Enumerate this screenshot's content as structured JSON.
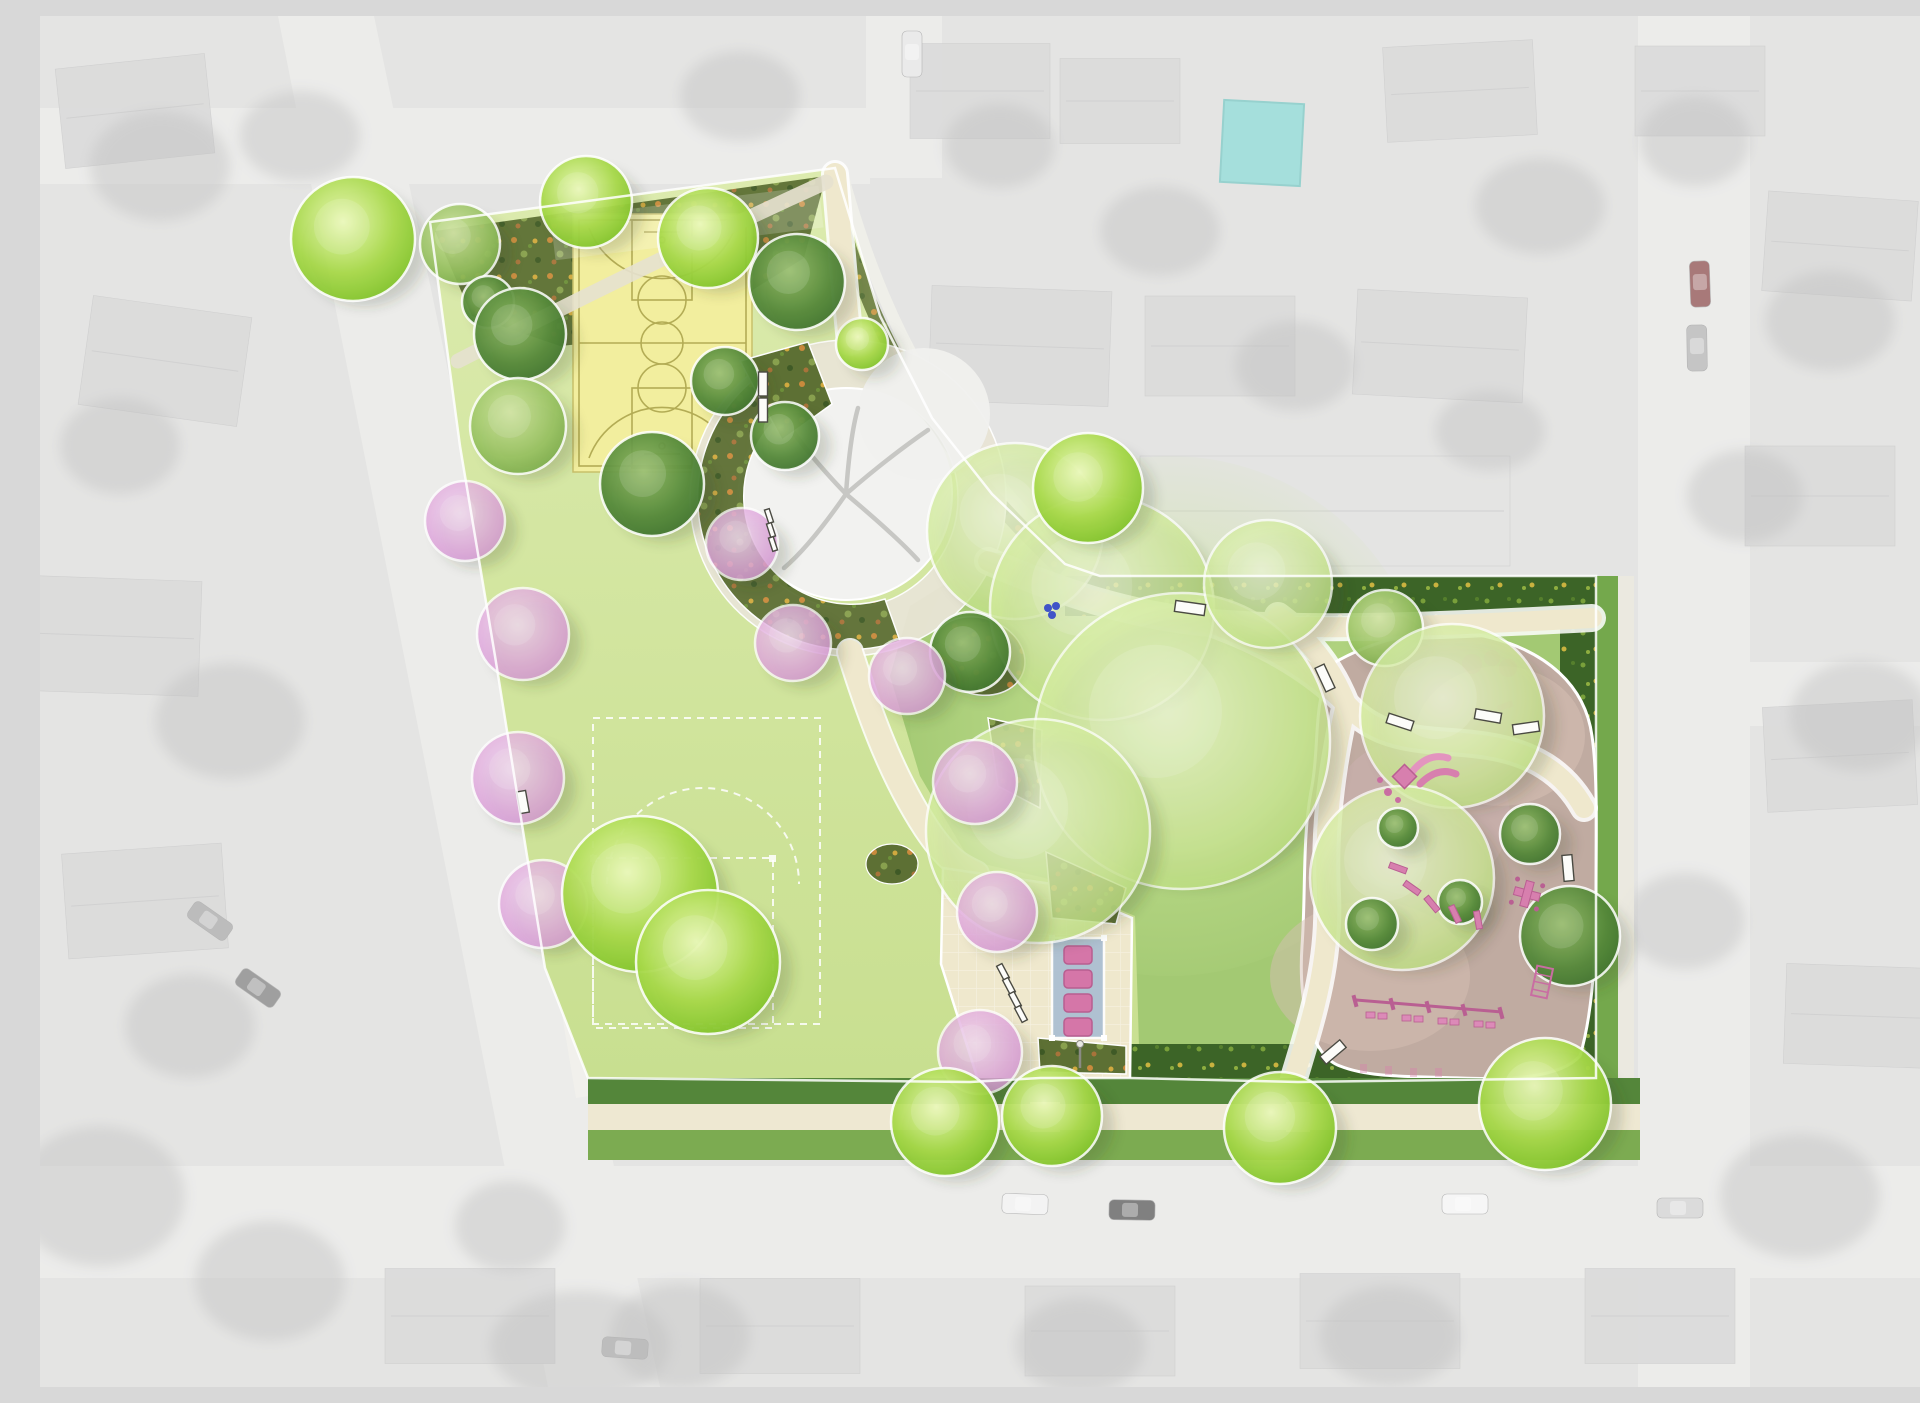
{
  "meta": {
    "description": "Rendered park landscape master plan overlaid on a grayscale aerial photograph of a residential neighborhood. The plan shows a basketball court, a large multi-use lawn field with dashed white field markings, a central plaza ring around an existing preserved tree, curving cream pathways with benches, flowering pink trees, a shaded picnic area with four tables, and a rounded playground with pink play equipment and a swing set, all bordered by shrub beds, hedges and bright green street trees.",
    "canvas": {
      "width": 1920,
      "height": 1371
    }
  },
  "palette": {
    "aerial_bg": "#d7d7d5",
    "road": "#e2e2e0",
    "house": "#c9c9c9",
    "house_light": "#d8d8d6",
    "pool": "#72cfca",
    "lawn_top": "#dcebae",
    "lawn_bottom": "#c8df90",
    "glade": "#a3c973",
    "glade_light": "#cbe697",
    "path": "#efe8cd",
    "path_pale": "#e6e1cf",
    "ring": "#e9e5d6",
    "court_fill": "#f2ee9e",
    "court_line": "#b3ac55",
    "field_line": "#ffffff",
    "bed_base": "#5d7034",
    "hedge_base": "#3c6427",
    "playground_surface": "#c0aba1",
    "playground_light": "#d6bfb4",
    "equipment_pink": "#d77fae",
    "equipment_pink_dark": "#b95f92",
    "picnic_canopy": "#a9bdd2",
    "picnic_table": "#d576a8",
    "verge_dark": "#54863a",
    "verge_light": "#7cab51",
    "sidewalk": "#eee8d2",
    "existing_tree": "#f2f2f0",
    "bench_fill": "#fcfcf9",
    "bench_stroke": "#4a4a42",
    "fountain_blue": "#4054c8",
    "outline_white": "#ffffff"
  },
  "features": [
    {
      "id": "basketball-court",
      "name": "basketball court"
    },
    {
      "id": "multiuse-field",
      "name": "multi-use lawn field with dashed markings"
    },
    {
      "id": "central-ring-plaza",
      "name": "circular plaza around existing preserved tree"
    },
    {
      "id": "shrub-crescent-beds",
      "name": "crescent planting beds"
    },
    {
      "id": "picnic-shelter",
      "name": "shade structure with 4 picnic tables",
      "table_count": 4
    },
    {
      "id": "playground",
      "name": "playground with safety surfacing"
    },
    {
      "id": "swing-set",
      "name": "swing set"
    },
    {
      "id": "slide-structure",
      "name": "slide play structure"
    },
    {
      "id": "benches",
      "name": "park benches"
    },
    {
      "id": "flowering-trees",
      "name": "pink flowering trees"
    },
    {
      "id": "street-trees",
      "name": "bright green street trees"
    },
    {
      "id": "drinking-fountain",
      "name": "blue site furnishing cluster"
    }
  ],
  "aerial": {
    "houses": [
      [
        95,
        95,
        150,
        100,
        -6
      ],
      [
        125,
        345,
        160,
        110,
        8
      ],
      [
        75,
        620,
        170,
        115,
        2
      ],
      [
        105,
        885,
        160,
        105,
        -4
      ],
      [
        940,
        75,
        140,
        95,
        0
      ],
      [
        1080,
        85,
        120,
        85,
        0
      ],
      [
        1420,
        75,
        150,
        95,
        -3
      ],
      [
        1660,
        75,
        130,
        90,
        0
      ],
      [
        1800,
        230,
        150,
        100,
        4
      ],
      [
        1780,
        480,
        150,
        100,
        0
      ],
      [
        1800,
        740,
        150,
        105,
        -3
      ],
      [
        1820,
        1000,
        150,
        100,
        2
      ],
      [
        980,
        330,
        180,
        115,
        2
      ],
      [
        1180,
        330,
        150,
        100,
        0
      ],
      [
        1400,
        330,
        170,
        105,
        3
      ],
      [
        1285,
        495,
        370,
        110,
        0,
        "#d8d8d6"
      ],
      [
        430,
        1300,
        170,
        95,
        0
      ],
      [
        740,
        1310,
        160,
        95,
        0
      ],
      [
        1060,
        1315,
        150,
        90,
        0
      ],
      [
        1340,
        1305,
        160,
        95,
        0
      ],
      [
        1620,
        1300,
        150,
        95,
        0
      ]
    ],
    "tree_blobs": [
      [
        120,
        150,
        70,
        55
      ],
      [
        80,
        430,
        60,
        48
      ],
      [
        190,
        705,
        75,
        58
      ],
      [
        150,
        1010,
        65,
        52
      ],
      [
        60,
        1180,
        85,
        70
      ],
      [
        230,
        1265,
        75,
        60
      ],
      [
        700,
        80,
        60,
        45
      ],
      [
        960,
        130,
        55,
        42
      ],
      [
        1120,
        215,
        60,
        45
      ],
      [
        1500,
        190,
        65,
        48
      ],
      [
        1655,
        125,
        55,
        45
      ],
      [
        1790,
        305,
        65,
        50
      ],
      [
        1705,
        480,
        58,
        46
      ],
      [
        1820,
        700,
        70,
        55
      ],
      [
        1645,
        905,
        60,
        48
      ],
      [
        1760,
        1180,
        80,
        62
      ],
      [
        1350,
        1320,
        70,
        50
      ],
      [
        1040,
        1330,
        65,
        48
      ],
      [
        640,
        1320,
        70,
        52
      ],
      [
        470,
        1210,
        55,
        45
      ],
      [
        905,
        455,
        55,
        40
      ],
      [
        1255,
        350,
        60,
        45
      ],
      [
        1450,
        415,
        55,
        40
      ],
      [
        540,
        1330,
        90,
        55
      ],
      [
        260,
        120,
        60,
        45
      ]
    ],
    "cars": [
      [
        170,
        905,
        35,
        "#9a9a9a"
      ],
      [
        218,
        972,
        35,
        "#6e6e6e"
      ],
      [
        985,
        1188,
        2,
        "#ededed"
      ],
      [
        1092,
        1194,
        1,
        "#3f3f3f"
      ],
      [
        1425,
        1188,
        0,
        "#f2f2f2"
      ],
      [
        1640,
        1192,
        0,
        "#c9c9c9"
      ],
      [
        1660,
        268,
        88,
        "#7c3434"
      ],
      [
        1657,
        332,
        89,
        "#a8a8a8"
      ],
      [
        872,
        38,
        90,
        "#e0e0e0"
      ],
      [
        585,
        1332,
        4,
        "#9c9c9c"
      ]
    ],
    "pool": [
      1182,
      86,
      80,
      82,
      3
    ]
  },
  "park": {
    "trees": [
      [
        "bright",
        313,
        223,
        62
      ],
      [
        "bright",
        546,
        186,
        46
      ],
      [
        "bright",
        668,
        222,
        50
      ],
      [
        "bright",
        822,
        328,
        26
      ],
      [
        "medium",
        420,
        228,
        40
      ],
      [
        "dark",
        448,
        286,
        26
      ],
      [
        "dark",
        480,
        318,
        46
      ],
      [
        "medium",
        478,
        410,
        48
      ],
      [
        "dark",
        757,
        266,
        48
      ],
      [
        "dark",
        685,
        365,
        34
      ],
      [
        "dark",
        612,
        468,
        52
      ],
      [
        "dark",
        745,
        420,
        34
      ],
      [
        "light",
        975,
        515,
        88
      ],
      [
        "light",
        1062,
        592,
        112
      ],
      [
        "light",
        1142,
        725,
        148
      ],
      [
        "light",
        998,
        815,
        112
      ],
      [
        "bright",
        1048,
        472,
        55
      ],
      [
        "light",
        1228,
        568,
        64
      ],
      [
        "medium",
        1345,
        612,
        38
      ],
      [
        "light",
        1412,
        700,
        92
      ],
      [
        "light",
        1362,
        862,
        92
      ],
      [
        "dark",
        930,
        636,
        40
      ],
      [
        "pink",
        425,
        505,
        40
      ],
      [
        "pink",
        483,
        618,
        46
      ],
      [
        "pink",
        478,
        762,
        46
      ],
      [
        "pink",
        503,
        888,
        44
      ],
      [
        "pink",
        702,
        528,
        36
      ],
      [
        "pink",
        753,
        627,
        38
      ],
      [
        "pink",
        867,
        660,
        38
      ],
      [
        "pink",
        935,
        766,
        42
      ],
      [
        "pink",
        957,
        896,
        40
      ],
      [
        "pink",
        940,
        1036,
        42
      ],
      [
        "bright",
        600,
        878,
        78
      ],
      [
        "bright",
        668,
        946,
        72
      ],
      [
        "dark",
        1358,
        812,
        20
      ],
      [
        "dark",
        1420,
        886,
        22
      ],
      [
        "dark",
        1490,
        818,
        30
      ],
      [
        "dark",
        1332,
        908,
        26
      ],
      [
        "dark",
        1530,
        920,
        50
      ],
      [
        "bright",
        905,
        1106,
        54
      ],
      [
        "bright",
        1012,
        1100,
        50
      ],
      [
        "bright",
        1240,
        1112,
        56
      ],
      [
        "bright",
        1505,
        1088,
        66
      ]
    ],
    "benches": [
      [
        723,
        368,
        90,
        24,
        9
      ],
      [
        723,
        394,
        90,
        24,
        9
      ],
      [
        1150,
        592,
        8,
        30,
        11
      ],
      [
        1285,
        662,
        65,
        26,
        10
      ],
      [
        1360,
        706,
        18,
        26,
        10
      ],
      [
        1448,
        700,
        10,
        26,
        10
      ],
      [
        1486,
        712,
        -8,
        26,
        10
      ],
      [
        1528,
        852,
        85,
        26,
        10
      ],
      [
        1293,
        1036,
        -40,
        26,
        10
      ],
      [
        483,
        786,
        80,
        22,
        9
      ],
      [
        729,
        500,
        72,
        14,
        5
      ],
      [
        731,
        514,
        72,
        14,
        5
      ],
      [
        733,
        528,
        72,
        14,
        5
      ],
      [
        963,
        956,
        62,
        16,
        6
      ],
      [
        969,
        970,
        62,
        16,
        6
      ],
      [
        975,
        984,
        62,
        16,
        6
      ],
      [
        981,
        998,
        62,
        16,
        6
      ]
    ]
  }
}
